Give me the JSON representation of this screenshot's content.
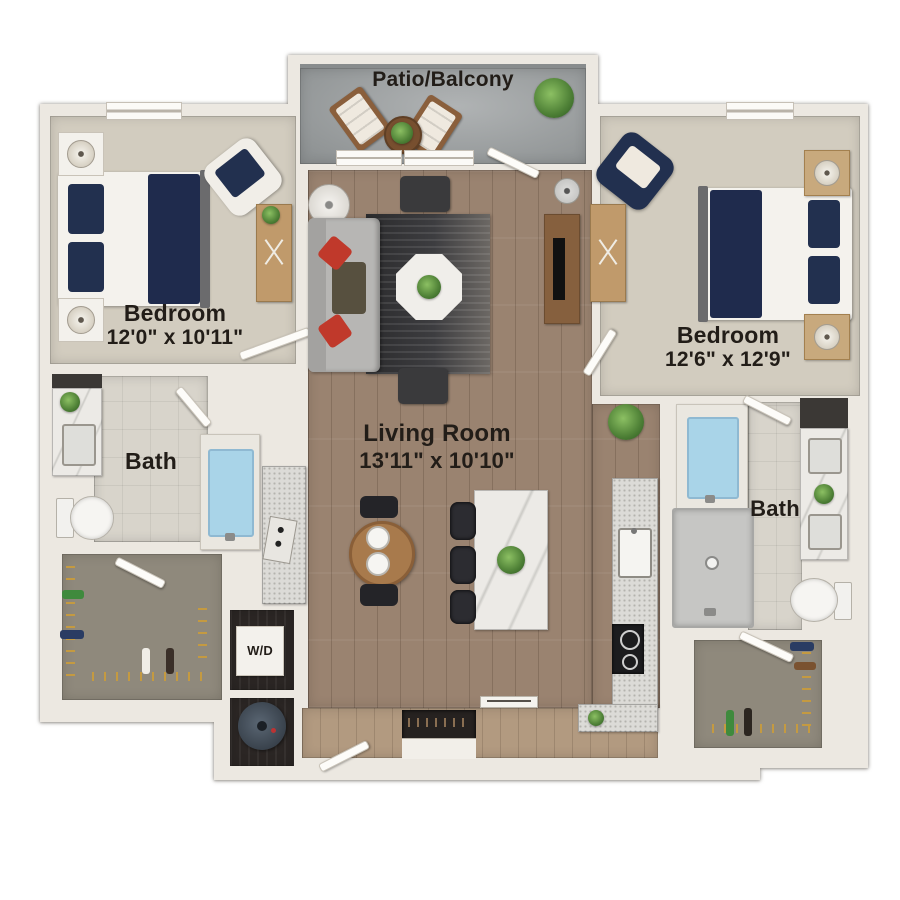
{
  "plan": {
    "type": "apartment-floor-plan",
    "rooms": {
      "patio": {
        "label": "Patio/Balcony"
      },
      "bedroom_left": {
        "label": "Bedroom",
        "dims": "12'0\" x 10'11\""
      },
      "bedroom_right": {
        "label": "Bedroom",
        "dims": "12'6\" x 12'9\""
      },
      "living": {
        "label": "Living Room",
        "dims": "13'11\" x 10'10\""
      },
      "bath_left": {
        "label": "Bath"
      },
      "bath_right": {
        "label": "Bath"
      },
      "laundry": {
        "label": "W/D"
      }
    },
    "colors": {
      "wall": "#ece8e1",
      "carpet": "#d2ccbf",
      "hardwood": "#9a8370",
      "tile": "#d8d4cb",
      "closet_carpet": "#8f897c",
      "concrete": "#9da0a1",
      "accent_navy": "#22304f",
      "accent_red": "#c0392b",
      "tub_blue": "#a9d4e8"
    }
  }
}
